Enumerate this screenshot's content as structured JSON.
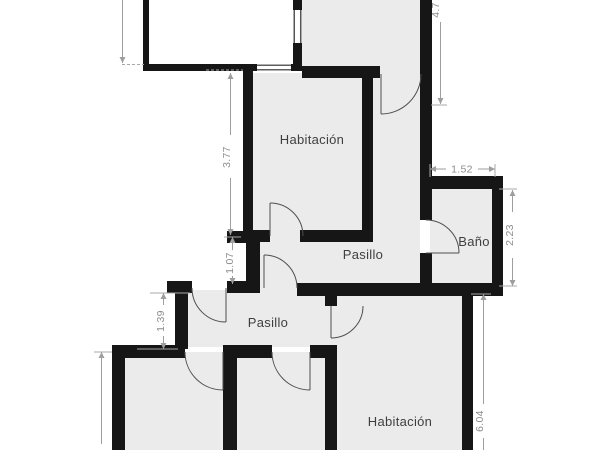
{
  "title": "floor-plan",
  "rooms": {
    "bedroom_top": {
      "label": "Habitación"
    },
    "hallway_upper": {
      "label": "Pasillo"
    },
    "bathroom": {
      "label": "Baño"
    },
    "hallway_lower": {
      "label": "Pasillo"
    },
    "bedroom_bottom": {
      "label": "Habitación"
    }
  },
  "dimensions": {
    "upper_right_height": "4.7",
    "bedroom_top_height": "3.77",
    "bathroom_width": "1.52",
    "bathroom_height": "2.23",
    "hallway_left_wall": "1.07",
    "entry_left_wall": "1.39",
    "bedroom_bottom_height": "6.04",
    "bottom_left_height_partial": "3"
  },
  "colors": {
    "wall": "#161616",
    "floor": "#ebebeb",
    "dimension": "#9e9e9e",
    "label": "#3f3f3f",
    "background": "#ffffff"
  }
}
